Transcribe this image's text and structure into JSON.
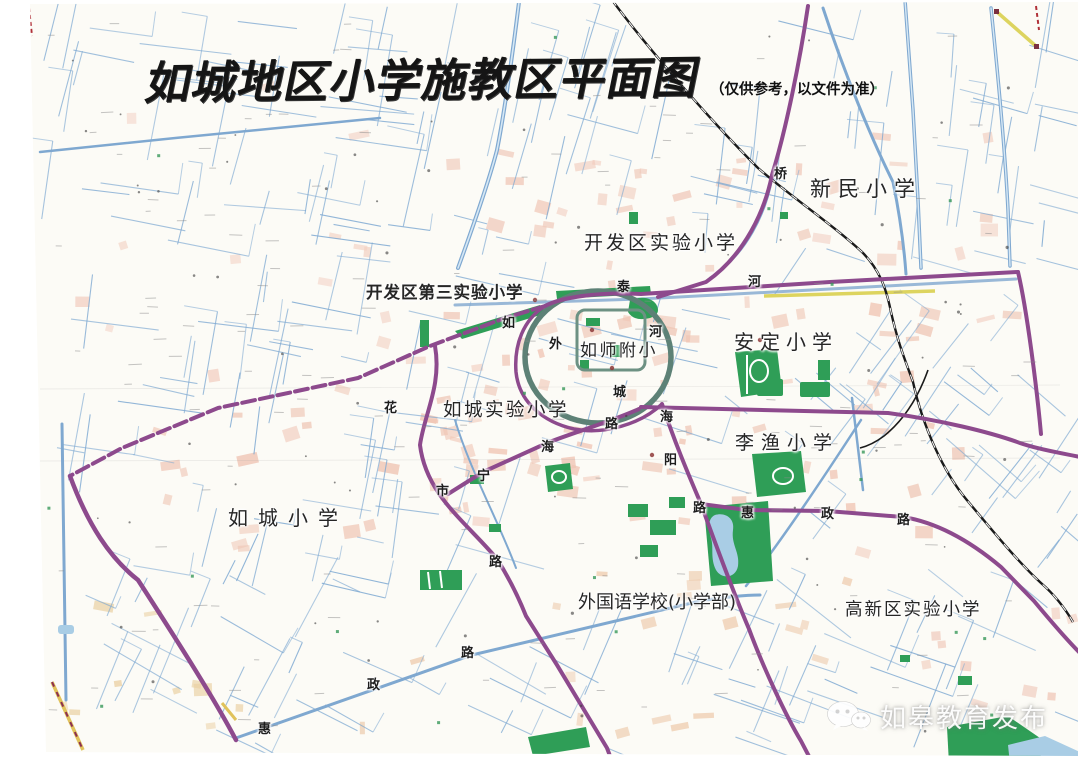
{
  "title": {
    "text": "如城地区小学施教区平面图",
    "note": "（仅供参考，以文件为准）"
  },
  "watermark": {
    "source": "如皋教育发布",
    "icon": "wechat-icon"
  },
  "map": {
    "schools": [
      {
        "name": "新民小学"
      },
      {
        "name": "开发区实验小学"
      },
      {
        "name": "开发区第三实验小学"
      },
      {
        "name": "安定小学"
      },
      {
        "name": "如师附小"
      },
      {
        "name": "如城实验小学"
      },
      {
        "name": "李渔小学"
      },
      {
        "name": "如城小学"
      },
      {
        "name": "外国语学校(小学部)"
      },
      {
        "name": "高新区实验小学"
      }
    ],
    "road_labels": [
      {
        "char": "如"
      },
      {
        "char": "泰"
      },
      {
        "char": "河"
      },
      {
        "char": "桥"
      },
      {
        "char": "外"
      },
      {
        "char": "城"
      },
      {
        "char": "河"
      },
      {
        "char": "花"
      },
      {
        "char": "市"
      },
      {
        "char": "宁"
      },
      {
        "char": "海"
      },
      {
        "char": "路"
      },
      {
        "char": "海"
      },
      {
        "char": "阳"
      },
      {
        "char": "路"
      },
      {
        "char": "惠"
      },
      {
        "char": "政"
      },
      {
        "char": "路"
      },
      {
        "char": "路"
      },
      {
        "char": "惠"
      },
      {
        "char": "政"
      },
      {
        "char": "路"
      }
    ],
    "colors": {
      "district_boundary": "#8d4a8d",
      "waterway": "#7fa8d0",
      "moat": "#5d8176",
      "park": "#2f9e57",
      "built_up": "#efc5b4",
      "railway": "#1a1a1a",
      "main_road": "#ddd45f"
    }
  }
}
